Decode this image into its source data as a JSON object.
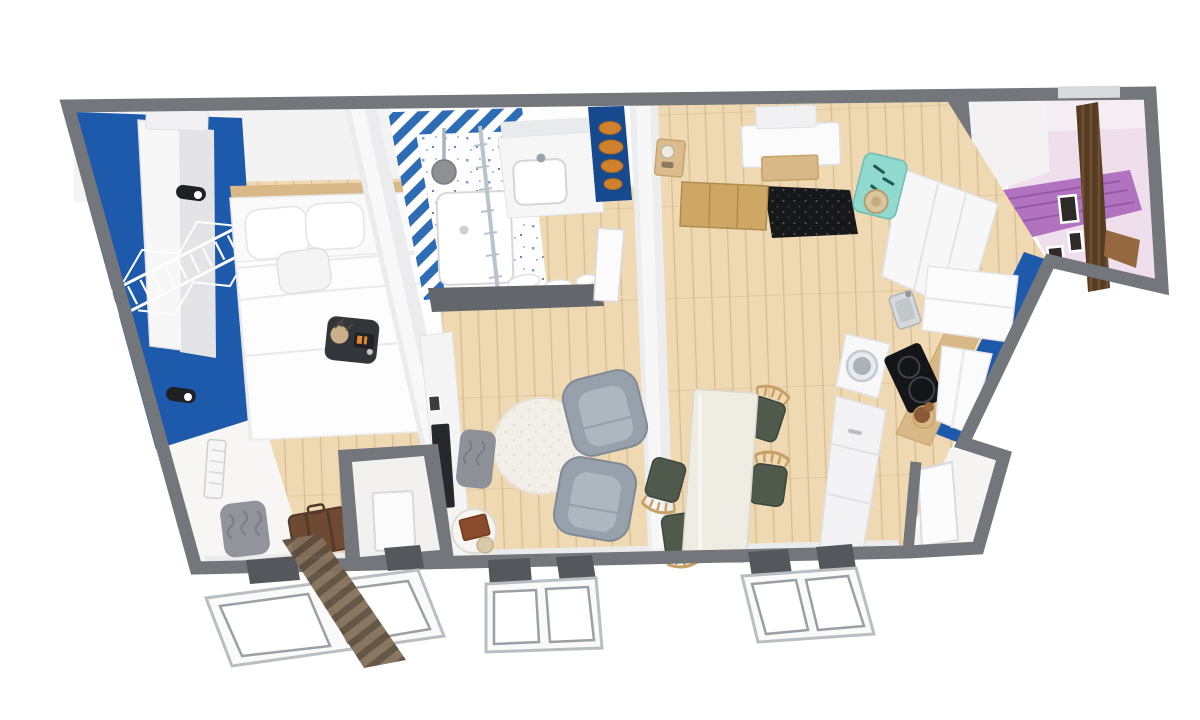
{
  "scene": {
    "description": "3D top-down architectural render of a one-bedroom apartment floor plan on a white background, walls cut horizontally, slight perspective with three fold-out windows along the bottom edge",
    "background": "#ffffff"
  },
  "canvas": {
    "width": 1200,
    "height": 720
  },
  "palette": {
    "wall_gray": "#73767b",
    "wall_face": "#f3f2f2",
    "wood_floor": "#eed9b2",
    "counter_wood": "#d9b887",
    "accent_blue": "#1e5aab",
    "niche_blue": "#17498f",
    "stripe_blue": "#2e6cb5",
    "mat_black": "#17181a",
    "teal_decor": "#8fd9cf",
    "purple_bed": "#b173bf",
    "lilac_wall": "#efdfec",
    "dark_wood": "#5c4026",
    "chair_seat_green": "#4f5a4d",
    "chair_wood": "#c8a066",
    "sofa_gray": "#97a1ab",
    "sofa_cushion": "#aeb7c0",
    "rug_cream": "#f2efe8",
    "suitcase_brown": "#6f4a33",
    "tv_black": "#26282c",
    "orange_decor": "#d0812e",
    "white_furniture": "#f7f7f8",
    "table_white": "#efece4"
  },
  "rooms": [
    {
      "id": "bedroom",
      "label": "bedroom",
      "items": [
        "double-bed",
        "pillows",
        "wood-headboard",
        "white-wardrobe",
        "clothes-drying-rack",
        "wall-lamp-upper",
        "wall-lamp-lower",
        "nightstand-with-alarm-clock",
        "radiator",
        "gray-wave-pouf",
        "leather-suitcase",
        "blue-accent-wall",
        "striped-runner-rug"
      ]
    },
    {
      "id": "bathroom",
      "label": "bathroom",
      "items": [
        "walk-in-shower",
        "shower-head",
        "glass-shower-screen",
        "blue-striped-tile-border",
        "speckled-tile-floor",
        "vanity-counter",
        "sink-basin",
        "mirror-strip",
        "towels-on-floor",
        "entry-header-wall",
        "white-door"
      ]
    },
    {
      "id": "hallway",
      "label": "hallway",
      "items": [
        "storage-closet",
        "tv-wall",
        "flat-screen-tv"
      ]
    },
    {
      "id": "living-area",
      "label": "living area",
      "items": [
        "armchair-upper",
        "armchair-lower",
        "round-shag-rug",
        "side-table-with-books",
        "gray-wave-bench"
      ]
    },
    {
      "id": "dining-area",
      "label": "dining area",
      "items": [
        "white-dining-table",
        "wood-chair-1",
        "wood-chair-2",
        "wood-chair-3",
        "wood-chair-4"
      ]
    },
    {
      "id": "entry",
      "label": "entry",
      "items": [
        "black-speckled-doormat",
        "wooden-sideboard",
        "wall-cabinet",
        "wood-shelf-box",
        "teal-coat-rack-with-hat",
        "white-wardrobe",
        "blue-niche-with-orange-decor",
        "shelf-with-jar"
      ]
    },
    {
      "id": "kitchen",
      "label": "kitchen",
      "items": [
        "fridge",
        "extractor-hood",
        "induction-hob",
        "steel-sink",
        "washing-machine",
        "cabinet-run",
        "wood-countertop",
        "blue-accent-wall",
        "teddy-bear-on-stool"
      ]
    },
    {
      "id": "vestibule",
      "label": "entry vestibule",
      "items": [
        "open-white-door"
      ]
    },
    {
      "id": "adjoining-room",
      "label": "adjoining room (seen beyond wall)",
      "items": [
        "purple-draped-bed",
        "lilac-walls",
        "dark-wood-wardrobe-panel",
        "wood-shelf",
        "picture-frames",
        "small-white-door"
      ]
    }
  ],
  "windows": {
    "count": 3,
    "style": "fold-out double-pane white frames below bottom wall"
  }
}
